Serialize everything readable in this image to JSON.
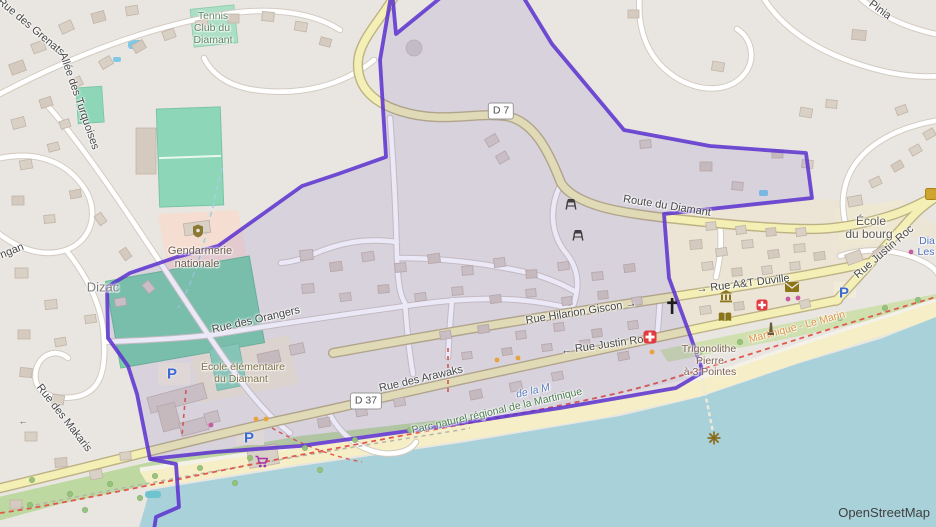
{
  "map": {
    "attribution": "OpenStreetMap",
    "shields": {
      "d7": "D 7",
      "d37": "D 37"
    },
    "streets": {
      "grenats": "Rue des Grenats",
      "turquoises": "Allée des Turquoises",
      "ngan_partial": "ngan",
      "makaris": "Rue des Makaris",
      "orangers": "Rue des Orangers",
      "arawaks": "Rue des Arawaks",
      "route_du_diamant": "Route du Diamant",
      "justin_roc": "Rue Justin Roc",
      "justin_roc_oneway": "← Rue Justin Roc",
      "hilarion_giscon": "Rue Hilarion Giscon →",
      "at_duville": "→ Rue A&T Duville",
      "pinia_partial": "Pinia"
    },
    "places": {
      "dizac": "Dizac",
      "tennis_club": [
        "Tennis",
        "Club du",
        "Diamant"
      ],
      "ecole_bourg": [
        "École",
        "du bourg"
      ],
      "ecole_elementaire": [
        "École élémentaire",
        "du Diamant"
      ],
      "gendarmerie": [
        "Gendarmerie",
        "nationale"
      ],
      "trigonolithe": [
        "Trigonolithe",
        "Pierre",
        "à 3 Pointes"
      ],
      "parc_naturel": "Parc naturel régional de la Martinique",
      "hiking_route": "Martinique - Le Marin",
      "bay_partial": "de la M",
      "poi_partial_dia": "Dia",
      "poi_partial_les": "Les"
    },
    "markers": {
      "parking": "P",
      "oneway": "←"
    },
    "colors": {
      "boundary": "#5a30cf",
      "water": "#a8d1da",
      "road_primary": "#f4efb5",
      "pitch": "#8ed6b8",
      "park": "#bdd8a0",
      "beach": "#f6eec6"
    }
  }
}
